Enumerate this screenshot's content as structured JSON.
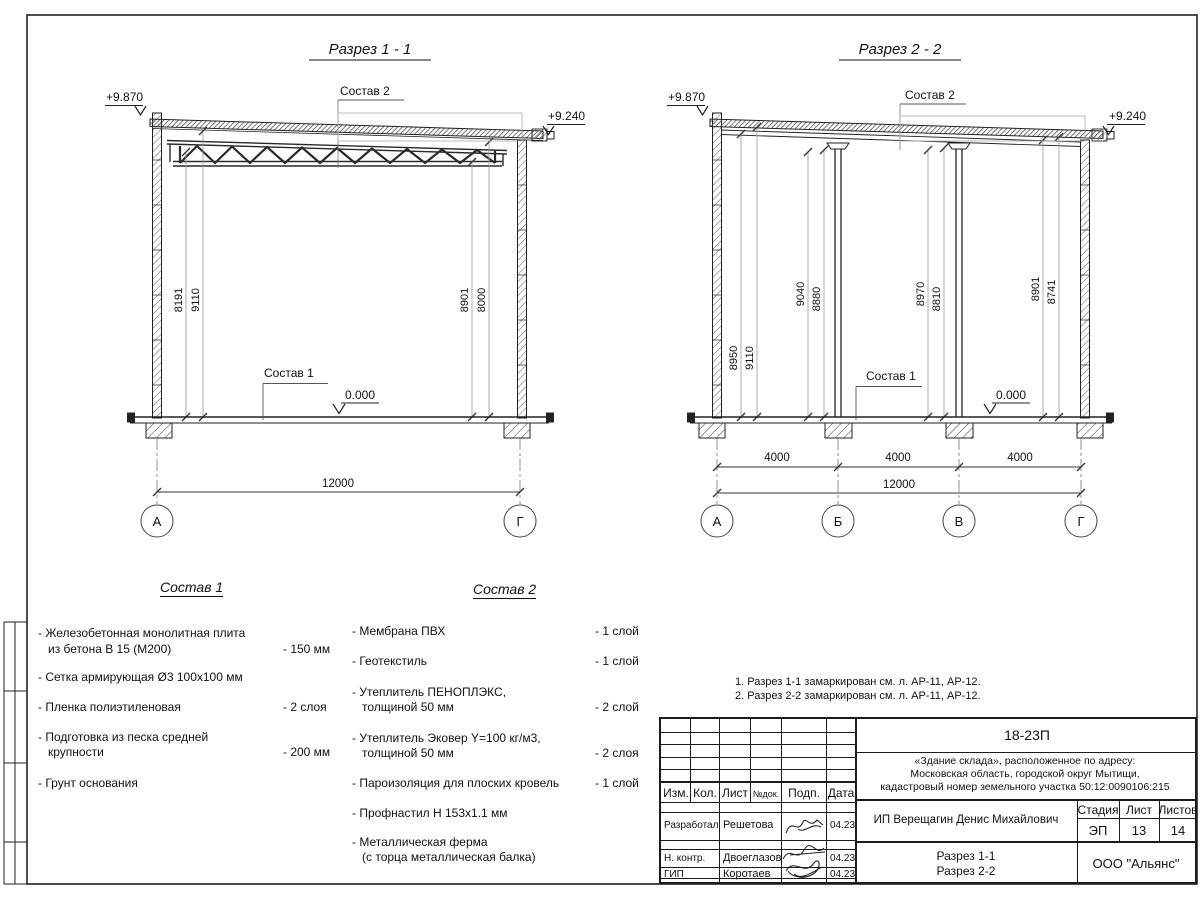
{
  "s1": {
    "title": "Разрез 1 - 1",
    "elev_left": "+9.870",
    "elev_right": "+9.240",
    "zero": "0.000",
    "sostav2_label": "Состав 2",
    "sostav1_label": "Состав 1",
    "dims": [
      "8191",
      "9110",
      "8901",
      "8000"
    ],
    "total": "12000",
    "axes": [
      "А",
      "Г"
    ]
  },
  "s2": {
    "title": "Разрез 2 - 2",
    "elev_left": "+9.870",
    "elev_right": "+9.240",
    "zero": "0.000",
    "sostav2_label": "Состав 2",
    "sostav1_label": "Состав 1",
    "dims": [
      "8950",
      "9110",
      "9040",
      "8880",
      "8970",
      "8810",
      "8901",
      "8741"
    ],
    "spans": [
      "4000",
      "4000",
      "4000"
    ],
    "total": "12000",
    "axes": [
      "А",
      "Б",
      "В",
      "Г"
    ]
  },
  "sostav1": {
    "title": "Состав 1",
    "items": [
      {
        "l1": "- Железобетонная  монолитная плита",
        "l2": "из бетона В 15 (М200)",
        "v": "- 150 мм"
      },
      {
        "l1": "- Сетка армирующая Ø3 100х100 мм",
        "l2": "",
        "v": ""
      },
      {
        "l1": "- Пленка полиэтиленовая",
        "l2": "",
        "v": "-  2 слоя"
      },
      {
        "l1": "- Подготовка из песка средней",
        "l2": "крупности",
        "v": "- 200 мм"
      },
      {
        "l1": "- Грунт основания",
        "l2": "",
        "v": ""
      }
    ]
  },
  "sostav2": {
    "title": "Состав 2",
    "items": [
      {
        "l1": "- Мембрана ПВХ",
        "l2": "",
        "v": "- 1 слой"
      },
      {
        "l1": "- Геотекстиль",
        "l2": "",
        "v": "- 1 слой"
      },
      {
        "l1": "- Утеплитель ПЕНОПЛЭКС,",
        "l2": "толщиной 50 мм",
        "v": "- 2 слой"
      },
      {
        "l1": "- Утеплитель Эковер Y=100 кг/м3,",
        "l2": "толщиной 50 мм",
        "v": "- 2 слоя"
      },
      {
        "l1": "- Пароизоляция для плоских кровель",
        "l2": "",
        "v": "- 1 слой"
      },
      {
        "l1": "- Профнастил Н 153х1.1 мм",
        "l2": "",
        "v": ""
      },
      {
        "l1": "- Металлическая ферма",
        "l2": "(с торца металлическая балка)",
        "v": ""
      }
    ]
  },
  "notes": [
    "1. Разрез 1-1 замаркирован см. л. АР-11, АР-12.",
    "2. Разрез 2-2 замаркирован см. л. АР-11, АР-12."
  ],
  "tb": {
    "code": "18-23П",
    "obj1": "«Здание склада», расположенное по адресу:",
    "obj2": "Московская область, городской округ Мытищи,",
    "obj3": "кадастровый номер земельного участка 50:12:0090106:215",
    "col_izm": "Изм.",
    "col_kol": "Кол.",
    "col_list": "Лист",
    "col_ndok": "№док.",
    "col_podp": "Подп.",
    "col_data": "Дата",
    "r1_role": "Разработал",
    "r1_name": "Решетова",
    "r1_date": "04.23",
    "r2_role": "Н. контр.",
    "r2_name": "Двоеглазов",
    "r2_date": "04.23",
    "r3_role": "ГИП",
    "r3_name": "Коротаев",
    "r3_date": "04.23",
    "client": "ИП Верещагин Денис Михайлович",
    "stage_label": "Стадия",
    "sheet_label": "Лист",
    "sheets_label": "Листов",
    "stage": "ЭП",
    "sheet": "13",
    "sheets": "14",
    "dwg1": "Разрез 1-1",
    "dwg2": "Разрез 2-2",
    "company": "ООО \"Альянс\""
  }
}
